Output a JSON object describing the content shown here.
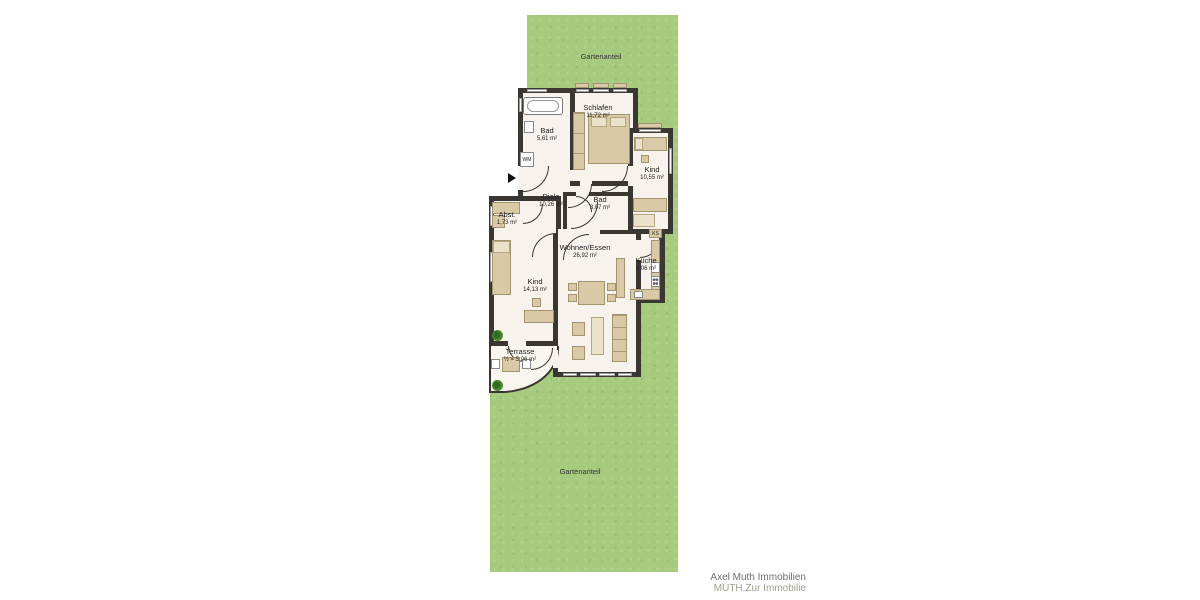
{
  "garden": {
    "top_label": "Gartenanteil",
    "bottom_label": "Gartenanteil"
  },
  "rooms": [
    {
      "name": "Bad",
      "area": "5,61 m²"
    },
    {
      "name": "Schlafen",
      "area": "11,72 m²"
    },
    {
      "name": "Kind",
      "area": "10,55 m²"
    },
    {
      "name": "Diele",
      "area": "10,26 m²"
    },
    {
      "name": "Bad",
      "area": "3,07 m²"
    },
    {
      "name": "Abst.",
      "area": "1,73 m²"
    },
    {
      "name": "Wohnen/Essen",
      "area": "26,92 m²"
    },
    {
      "name": "Küche",
      "area": "8,06 m²"
    },
    {
      "name": "Kind",
      "area": "14,13 m²"
    },
    {
      "name": "Terrasse",
      "area": "½ = 5,06 m²"
    }
  ],
  "appliances": {
    "washing_machine": "WM",
    "fridge": "KS"
  },
  "footer": {
    "line1": "Axel Muth Immobilien",
    "line2": "MUTH.Zur Immobilie"
  },
  "colors": {
    "garden_green": "#a6cb7e",
    "wall_dark": "#3a3632",
    "floor": "#f7f3ec",
    "furniture_tan": "#d9c9a6",
    "plant_green": "#4e8f33"
  }
}
